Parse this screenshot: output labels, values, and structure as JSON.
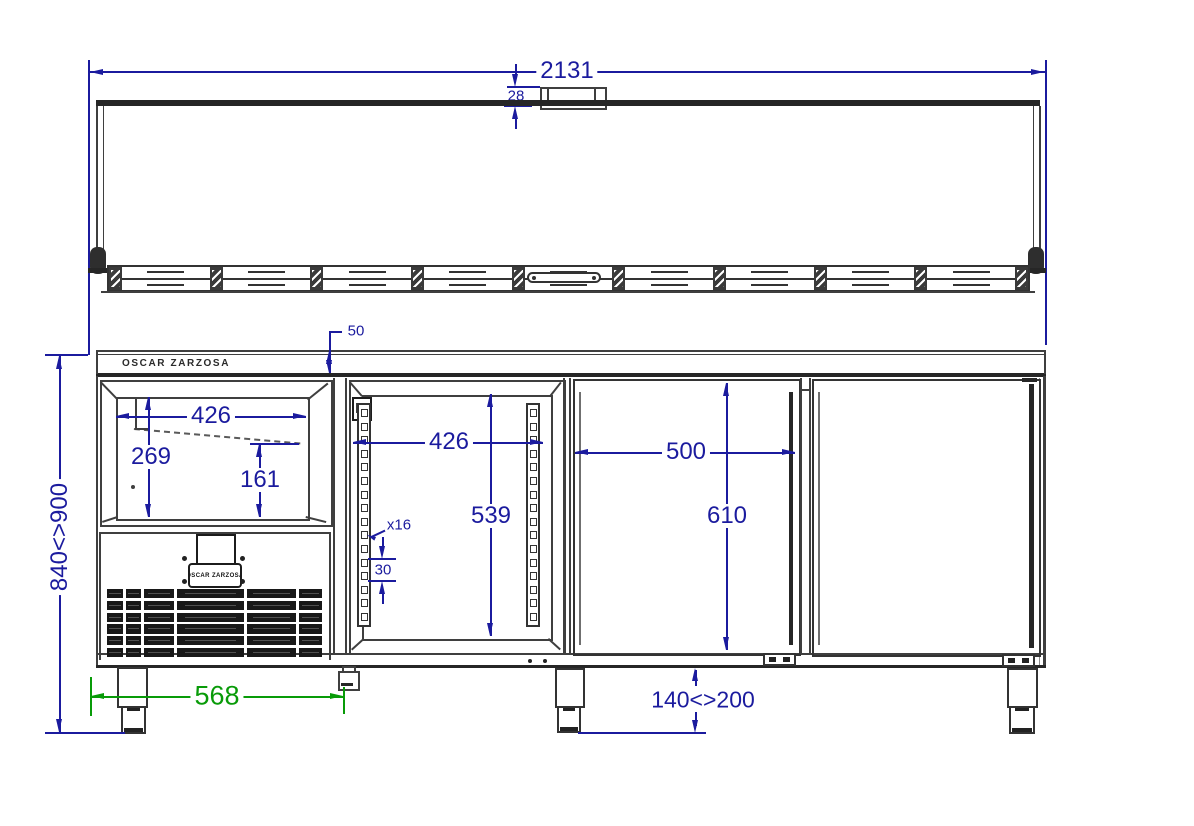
{
  "brand": {
    "logo_text": "OSCAR ZARZOSA",
    "badge_text": "OSCAR ZARZOSA"
  },
  "dims": {
    "overall_width": "2131",
    "lid_handle_height": "28",
    "worktop_thickness": "50",
    "glass_lid_width": "426",
    "glass_lid_depth": "269",
    "glass_lid_inner_height": "161",
    "compartment_width": "426",
    "compartment_height": "539",
    "rail_positions": "x16",
    "rail_pitch": "30",
    "door_width": "500",
    "door_height": "610",
    "base_width": "568",
    "overall_height_range": "840<>900",
    "leg_height_range": "140<>200"
  },
  "counts": {
    "shelf_rail_slots": 16,
    "pan_segments": 9,
    "grille_columns": 6,
    "grille_rows": 6
  },
  "colors": {
    "dimension_blue": "#1b1b9e",
    "dimension_green": "#089b08",
    "line_gray": "#3f3f3f",
    "line_dark": "#262626",
    "background": "#ffffff"
  }
}
